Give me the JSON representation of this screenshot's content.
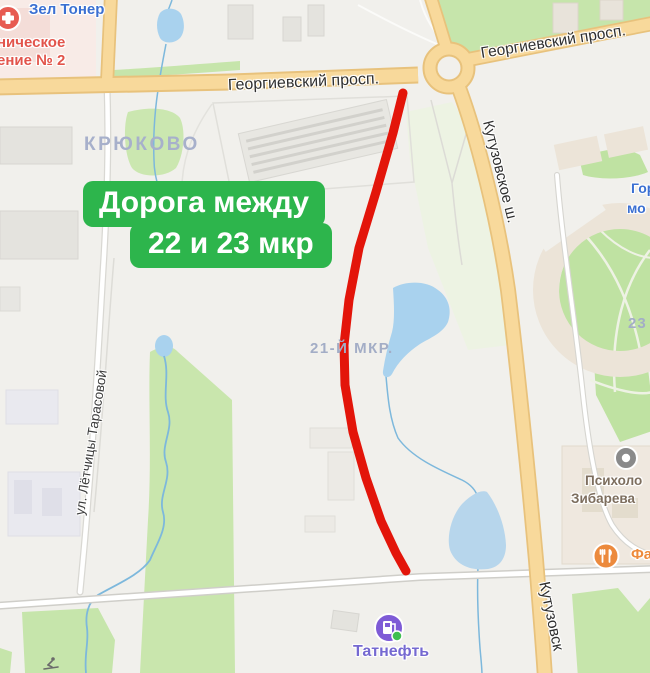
{
  "callout": {
    "line1": "Дорога между",
    "line2": "22 и 23 мкр"
  },
  "streets": {
    "georgievsky_mid": "Георгиевский просп.",
    "georgievsky_top": "Георгиевский просп.",
    "kutuzovskoe": "Кутузовское ш.",
    "kutuzovskoe_bottom": "Кутузовск",
    "tarasova": "ул. Лётчицы Тарасовой"
  },
  "districts": {
    "kryukovo": "КРЮКОВО",
    "mkr21": "21-Й МКР.",
    "mkr23": "23"
  },
  "pois": {
    "zel_toner": {
      "label": "Зел Тонер"
    },
    "clinic": {
      "line1": "ническое",
      "line2": "ение № 2"
    },
    "gorod": {
      "line1": "Гор",
      "line2": "мо"
    },
    "psych": {
      "line1": "Психоло",
      "line2": "Зибарева"
    },
    "cafe": {
      "label": "Фа"
    },
    "tatneft": {
      "label": "Татнефть"
    }
  },
  "colors": {
    "route_red": "#e3150a",
    "callout_green": "#2db54c",
    "road_yellow": "#f8d99b",
    "water_blue": "#a9d2ee",
    "park_green": "#c6e5ab"
  }
}
